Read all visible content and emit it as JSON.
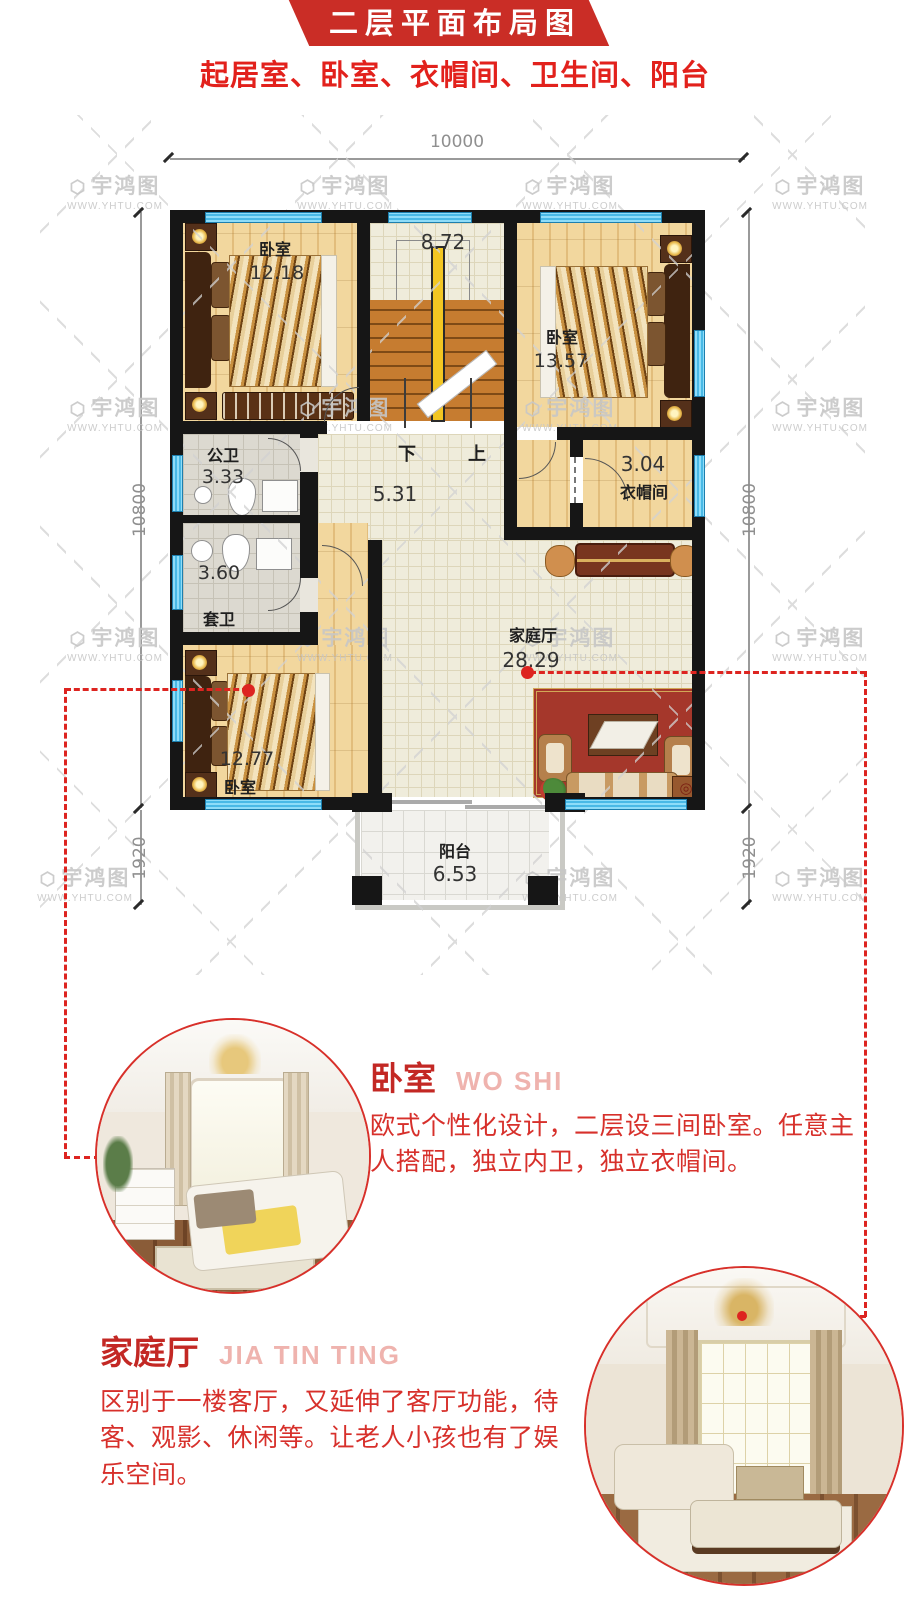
{
  "colors": {
    "accent_red": "#d7302b",
    "banner_red": "#ca2d26",
    "window_blue": "#5bc9ee",
    "wall_black": "#161616"
  },
  "header": {
    "title": "二层平面布局图",
    "subtitle": "起居室、卧室、衣帽间、卫生间、阳台"
  },
  "watermark": {
    "brand": "宇鸿图",
    "url": "WWW.YHTU.COM"
  },
  "plan": {
    "dims": {
      "width": "10000",
      "height": "10800",
      "balcony_depth": "1920"
    },
    "rooms": {
      "bedroom_top_left": {
        "name": "卧室",
        "area": "12.18"
      },
      "stairwell": {
        "area": "8.72",
        "down_label": "下",
        "up_label": "上"
      },
      "bedroom_top_right": {
        "name": "卧室",
        "area": "13.57"
      },
      "public_bath": {
        "name": "公卫",
        "area": "3.33"
      },
      "hallway": {
        "area": "5.31"
      },
      "cloakroom": {
        "name": "衣帽间",
        "area": "3.04"
      },
      "ensuite_bath": {
        "name": "套卫",
        "area": "3.60"
      },
      "family_hall": {
        "name": "家庭厅",
        "area": "28.29"
      },
      "bedroom_bottom": {
        "name": "卧室",
        "area": "12.77"
      },
      "balcony": {
        "name": "阳台",
        "area": "6.53"
      }
    }
  },
  "sections": {
    "bedroom": {
      "title": "卧室",
      "subtitle": "WO SHI",
      "body": "欧式个性化设计，二层设三间卧室。任意主人搭配，独立内卫，独立衣帽间。"
    },
    "family_hall": {
      "title": "家庭厅",
      "subtitle": "JIA TIN TING",
      "body": "区别于一楼客厅，又延伸了客厅功能，待客、观影、休闲等。让老人小孩也有了娱乐空间。"
    }
  }
}
